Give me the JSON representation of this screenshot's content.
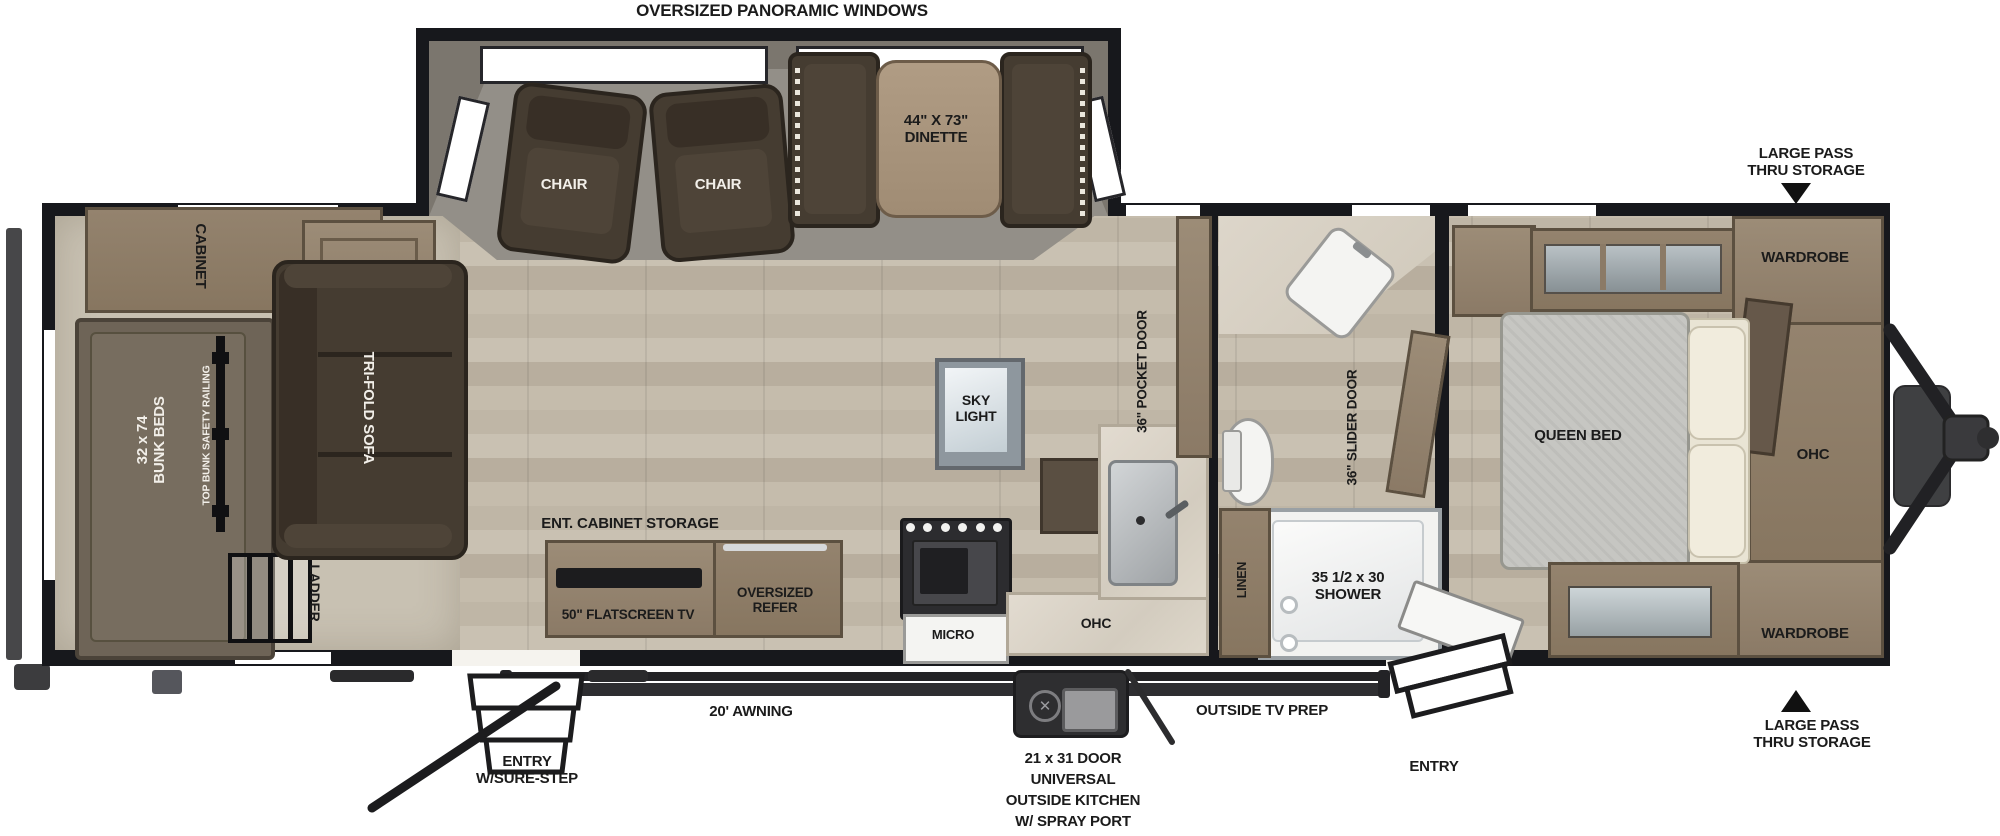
{
  "colors": {
    "wall": "#17181c",
    "floor_wood": "#c3baa9",
    "rear_carpet": "#c8c1b2",
    "slide_carpet": "#938f88",
    "cabinet_wood": "#8b7a66",
    "dark_upholstery": "#453c31",
    "counter_marble": "#d8d1c4",
    "white_fixture": "#f4f4f2",
    "label_text": "#1b1b1b",
    "label_text_light": "#f2efe9"
  },
  "exterior": {
    "panoramic_windows": "OVERSIZED PANORAMIC WINDOWS",
    "pass_thru_top": {
      "line1": "LARGE PASS",
      "line2": "THRU STORAGE"
    },
    "pass_thru_bottom": {
      "line1": "LARGE PASS",
      "line2": "THRU STORAGE"
    },
    "awning": "20' AWNING",
    "outside_tv": "OUTSIDE TV PREP",
    "outside_kitchen": {
      "line1": "21 x 31 DOOR",
      "line2": "UNIVERSAL",
      "line3": "OUTSIDE KITCHEN",
      "line4": "W/ SPRAY PORT"
    },
    "entry_rear": {
      "line1": "ENTRY",
      "line2": "W/SURE-STEP"
    },
    "entry_front": "ENTRY"
  },
  "bunk_room": {
    "cabinet": "CABINET",
    "bunk_size": "32 x 74",
    "bunk_name": "BUNK BEDS",
    "railing": "TOP BUNK SAFETY RAILING",
    "ladder": "LADDER"
  },
  "living_room": {
    "sofa": "TRI-FOLD SOFA",
    "chair_left": "CHAIR",
    "chair_right": "CHAIR",
    "dinette_size": "44\" X 73\"",
    "dinette_name": "DINETTE",
    "skylight_line1": "SKY",
    "skylight_line2": "LIGHT",
    "ent_cabinet": "ENT. CABINET STORAGE",
    "tv": "50\" FLATSCREEN TV",
    "refer_line1": "OVERSIZED",
    "refer_line2": "REFER",
    "micro": "MICRO",
    "ohc": "OHC",
    "pocket_door": "36\" POCKET DOOR"
  },
  "bathroom": {
    "linen": "LINEN",
    "shower_size": "35 1/2 x 30",
    "shower_name": "SHOWER",
    "slider_door": "36\" SLIDER DOOR"
  },
  "bedroom": {
    "bed": "QUEEN BED",
    "wardrobe_top": "WARDROBE",
    "ohc": "OHC",
    "wardrobe_bottom": "WARDROBE"
  }
}
